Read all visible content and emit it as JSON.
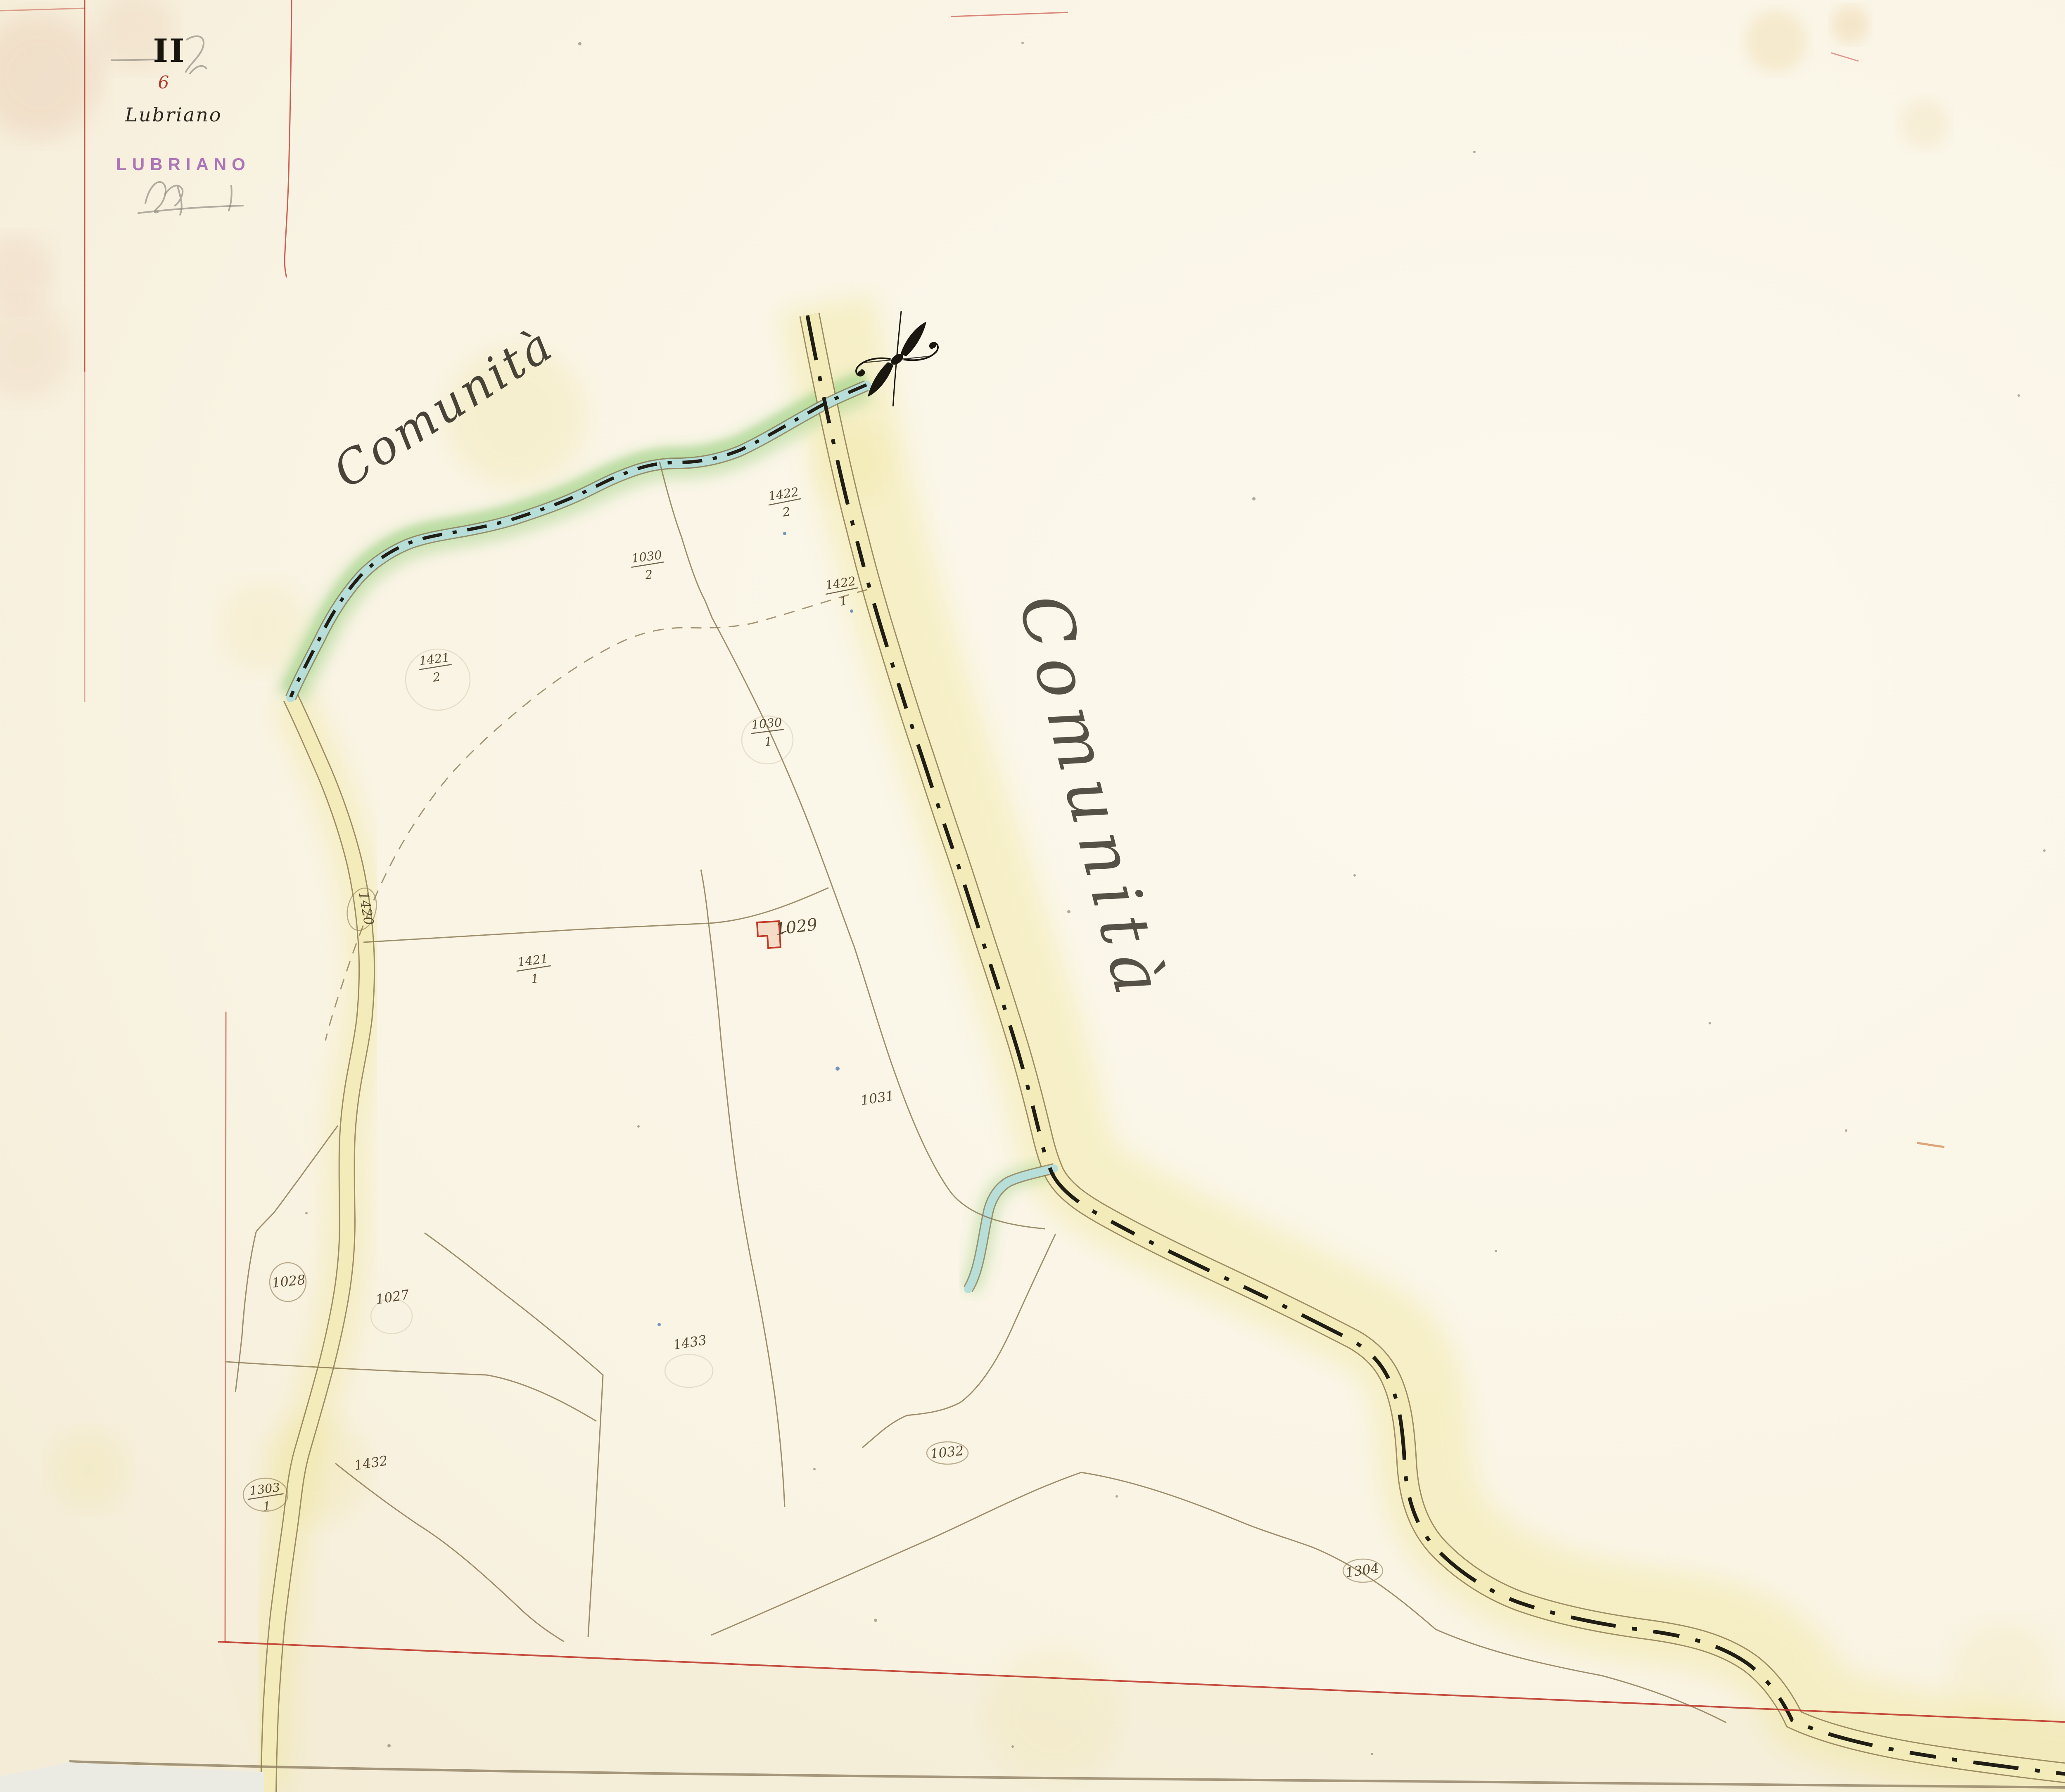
{
  "document": {
    "kind": "cadastral map sheet (scanned)"
  },
  "header": {
    "volume_numeral": "II",
    "sheet_number": "6",
    "town_script": "Lubriano",
    "town_stamp": "LUBRIANO"
  },
  "territory_labels": {
    "west": "Comunità",
    "east": "Comunità"
  },
  "parcels": {
    "fractions": [
      {
        "num": "1422",
        "den": "2"
      },
      {
        "num": "1030",
        "den": "2"
      },
      {
        "num": "1422",
        "den": "1"
      },
      {
        "num": "1421",
        "den": "2"
      },
      {
        "num": "1030",
        "den": "1"
      },
      {
        "num": "1421",
        "den": "1"
      },
      {
        "num": "1303",
        "den": "1"
      }
    ],
    "plain": [
      "1029",
      "1031",
      "1028",
      "1027",
      "1433",
      "1432",
      "1032",
      "1304",
      "1420"
    ]
  },
  "colors": {
    "frame_red": "#bf3a2e",
    "road_yellow": "#f3ecba",
    "stream_blue": "#b7ded9",
    "bank_green": "#a8d58f",
    "stamp_purple": "#9146a8",
    "ink_brown": "#4f3f26"
  }
}
